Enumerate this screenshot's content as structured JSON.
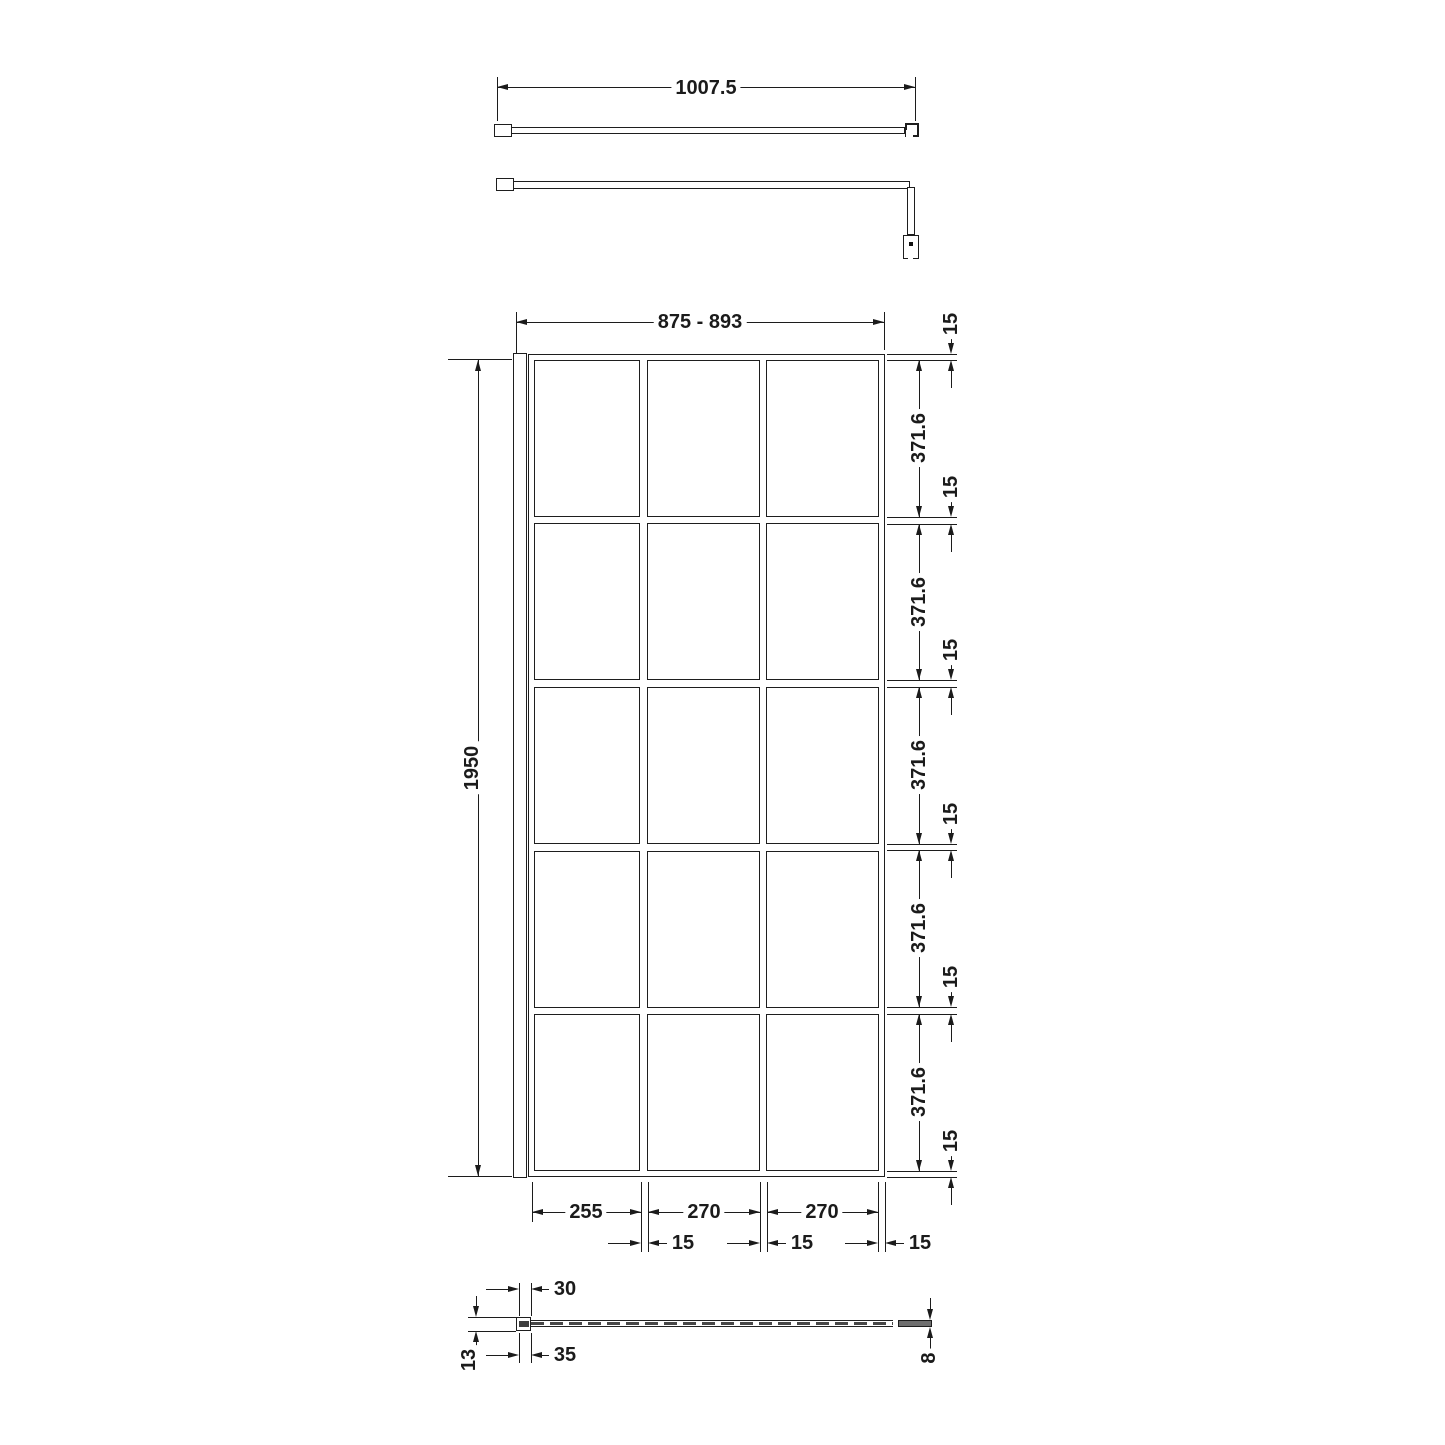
{
  "drawing": {
    "arm_top": {
      "length": "1007.5"
    },
    "front": {
      "width_range": "875 - 893",
      "height": "1950",
      "pane_opening": "371.6",
      "frame_profile": "15",
      "col_1": "255",
      "col_2": "270",
      "col_3": "270",
      "grid": {
        "columns": 3,
        "rows": 5
      }
    },
    "plan": {
      "channel_inner": "30",
      "channel_outer": "35",
      "wall_profile_depth": "13",
      "glass_thickness": "8"
    }
  }
}
